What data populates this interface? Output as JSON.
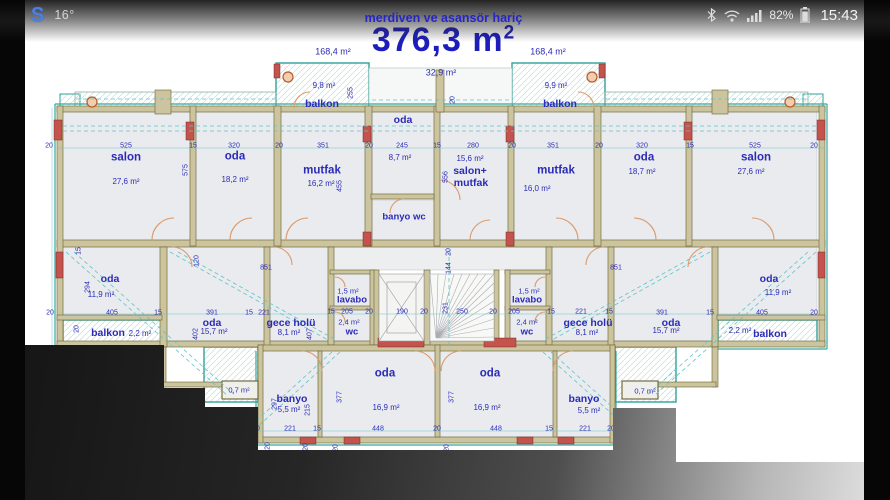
{
  "status_bar": {
    "app_letter": "S",
    "temperature": "16°",
    "battery_pct": "82%",
    "time": "15:43",
    "accent_blue": "#4d7fe3"
  },
  "header": {
    "note": "merdiven ve asansör hariç",
    "total_area": "376,3 m",
    "total_area_sup": "2",
    "text_color": "#1d1dbe"
  },
  "plan": {
    "colors": {
      "wall": "#cbc49e",
      "teal": "#2fa39a",
      "red": "#c4534e",
      "dim_cyan": "#5fc4c9",
      "text_navy": "#2b2bb8"
    },
    "labels": [
      {
        "t": "168,4 m²",
        "x": 333,
        "y": 52,
        "k": "a9"
      },
      {
        "t": "168,4 m²",
        "x": 548,
        "y": 52,
        "k": "a9"
      },
      {
        "t": "32,9 m²",
        "x": 441,
        "y": 73,
        "k": "a9"
      },
      {
        "t": "9,8 m²",
        "x": 324,
        "y": 86,
        "k": "a"
      },
      {
        "t": "balkon",
        "x": 322,
        "y": 104,
        "k": "n11"
      },
      {
        "t": "255",
        "x": 351,
        "y": 93,
        "k": "d",
        "r": 1
      },
      {
        "t": "9,9 m²",
        "x": 556,
        "y": 86,
        "k": "a"
      },
      {
        "t": "balkon",
        "x": 560,
        "y": 104,
        "k": "n11"
      },
      {
        "t": "oda",
        "x": 403,
        "y": 120,
        "k": "n11"
      },
      {
        "t": "20",
        "x": 453,
        "y": 100,
        "k": "d",
        "r": 1
      },
      {
        "t": "20",
        "x": 49,
        "y": 146,
        "k": "d"
      },
      {
        "t": "525",
        "x": 126,
        "y": 146,
        "k": "d"
      },
      {
        "t": "15",
        "x": 193,
        "y": 146,
        "k": "d"
      },
      {
        "t": "320",
        "x": 234,
        "y": 146,
        "k": "d"
      },
      {
        "t": "20",
        "x": 279,
        "y": 146,
        "k": "d"
      },
      {
        "t": "351",
        "x": 323,
        "y": 146,
        "k": "d"
      },
      {
        "t": "20",
        "x": 369,
        "y": 146,
        "k": "d"
      },
      {
        "t": "245",
        "x": 402,
        "y": 146,
        "k": "d"
      },
      {
        "t": "15",
        "x": 437,
        "y": 146,
        "k": "d"
      },
      {
        "t": "280",
        "x": 473,
        "y": 146,
        "k": "d"
      },
      {
        "t": "20",
        "x": 512,
        "y": 146,
        "k": "d"
      },
      {
        "t": "351",
        "x": 553,
        "y": 146,
        "k": "d"
      },
      {
        "t": "20",
        "x": 599,
        "y": 146,
        "k": "d"
      },
      {
        "t": "320",
        "x": 642,
        "y": 146,
        "k": "d"
      },
      {
        "t": "15",
        "x": 690,
        "y": 146,
        "k": "d"
      },
      {
        "t": "525",
        "x": 755,
        "y": 146,
        "k": "d"
      },
      {
        "t": "20",
        "x": 814,
        "y": 146,
        "k": "d"
      },
      {
        "t": "salon",
        "x": 126,
        "y": 158,
        "k": "n12"
      },
      {
        "t": "27,6 m²",
        "x": 126,
        "y": 182,
        "k": "a"
      },
      {
        "t": "oda",
        "x": 235,
        "y": 157,
        "k": "n12"
      },
      {
        "t": "18,2 m²",
        "x": 235,
        "y": 180,
        "k": "a"
      },
      {
        "t": "mutfak",
        "x": 322,
        "y": 171,
        "k": "n12"
      },
      {
        "t": "16,2 m²",
        "x": 321,
        "y": 184,
        "k": "a"
      },
      {
        "t": "8,7 m²",
        "x": 400,
        "y": 158,
        "k": "a"
      },
      {
        "t": "banyo wc",
        "x": 404,
        "y": 217,
        "k": "n10"
      },
      {
        "t": "15,6 m²",
        "x": 470,
        "y": 159,
        "k": "a"
      },
      {
        "t": "salon+",
        "x": 470,
        "y": 171,
        "k": "n11"
      },
      {
        "t": "mutfak",
        "x": 471,
        "y": 183,
        "k": "n11"
      },
      {
        "t": "mutfak",
        "x": 556,
        "y": 171,
        "k": "n12"
      },
      {
        "t": "16,0 m²",
        "x": 537,
        "y": 189,
        "k": "a"
      },
      {
        "t": "oda",
        "x": 644,
        "y": 158,
        "k": "n12"
      },
      {
        "t": "18,7 m²",
        "x": 642,
        "y": 172,
        "k": "a"
      },
      {
        "t": "salon",
        "x": 756,
        "y": 158,
        "k": "n12"
      },
      {
        "t": "27,6 m²",
        "x": 751,
        "y": 172,
        "k": "a"
      },
      {
        "t": "575",
        "x": 186,
        "y": 170,
        "k": "d",
        "r": 1
      },
      {
        "t": "455",
        "x": 340,
        "y": 186,
        "k": "d",
        "r": 1
      },
      {
        "t": "556",
        "x": 446,
        "y": 177,
        "k": "d",
        "r": 1
      },
      {
        "t": "oda",
        "x": 110,
        "y": 279,
        "k": "n11"
      },
      {
        "t": "11,9 m²",
        "x": 101,
        "y": 295,
        "k": "a"
      },
      {
        "t": "294",
        "x": 88,
        "y": 287,
        "k": "d",
        "r": 1
      },
      {
        "t": "15",
        "x": 79,
        "y": 251,
        "k": "d",
        "r": 1
      },
      {
        "t": "20",
        "x": 50,
        "y": 313,
        "k": "d"
      },
      {
        "t": "405",
        "x": 112,
        "y": 313,
        "k": "d"
      },
      {
        "t": "15",
        "x": 158,
        "y": 313,
        "k": "d"
      },
      {
        "t": "balkon",
        "x": 108,
        "y": 333,
        "k": "n11"
      },
      {
        "t": "2,2 m²",
        "x": 140,
        "y": 334,
        "k": "a"
      },
      {
        "t": "20",
        "x": 77,
        "y": 329,
        "k": "d",
        "r": 1
      },
      {
        "t": "851",
        "x": 266,
        "y": 268,
        "k": "d"
      },
      {
        "t": "851",
        "x": 616,
        "y": 268,
        "k": "d"
      },
      {
        "t": "120",
        "x": 197,
        "y": 261,
        "k": "d",
        "r": 1
      },
      {
        "t": "oda",
        "x": 212,
        "y": 323,
        "k": "n11"
      },
      {
        "t": "15,7 m²",
        "x": 214,
        "y": 332,
        "k": "a"
      },
      {
        "t": "391",
        "x": 212,
        "y": 313,
        "k": "d"
      },
      {
        "t": "402",
        "x": 196,
        "y": 334,
        "k": "d",
        "r": 1
      },
      {
        "t": "15",
        "x": 249,
        "y": 313,
        "k": "d"
      },
      {
        "t": "221",
        "x": 264,
        "y": 313,
        "k": "d"
      },
      {
        "t": "gece holü",
        "x": 291,
        "y": 323,
        "k": "n11"
      },
      {
        "t": "8,1 m²",
        "x": 289,
        "y": 333,
        "k": "a"
      },
      {
        "t": "407",
        "x": 310,
        "y": 334,
        "k": "d",
        "r": 1
      },
      {
        "t": "15",
        "x": 331,
        "y": 312,
        "k": "d"
      },
      {
        "t": "205",
        "x": 347,
        "y": 312,
        "k": "d"
      },
      {
        "t": "20",
        "x": 369,
        "y": 312,
        "k": "d"
      },
      {
        "t": "190",
        "x": 402,
        "y": 312,
        "k": "d"
      },
      {
        "t": "20",
        "x": 424,
        "y": 312,
        "k": "d"
      },
      {
        "t": "250",
        "x": 462,
        "y": 312,
        "k": "d"
      },
      {
        "t": "20",
        "x": 493,
        "y": 312,
        "k": "d"
      },
      {
        "t": "205",
        "x": 514,
        "y": 312,
        "k": "d"
      },
      {
        "t": "15",
        "x": 551,
        "y": 312,
        "k": "d"
      },
      {
        "t": "1,5 m²",
        "x": 348,
        "y": 291,
        "k": "a7"
      },
      {
        "t": "lavabo",
        "x": 352,
        "y": 300,
        "k": "n10"
      },
      {
        "t": "2,4 m²",
        "x": 349,
        "y": 322,
        "k": "a7"
      },
      {
        "t": "wc",
        "x": 352,
        "y": 332,
        "k": "n10"
      },
      {
        "t": "1,5 m²",
        "x": 529,
        "y": 291,
        "k": "a7"
      },
      {
        "t": "lavabo",
        "x": 527,
        "y": 300,
        "k": "n10"
      },
      {
        "t": "2,4 m²",
        "x": 527,
        "y": 322,
        "k": "a7"
      },
      {
        "t": "wc",
        "x": 527,
        "y": 332,
        "k": "n10"
      },
      {
        "t": "20",
        "x": 449,
        "y": 252,
        "k": "d",
        "r": 1
      },
      {
        "t": "144",
        "x": 449,
        "y": 268,
        "k": "d",
        "r": 1
      },
      {
        "t": "231",
        "x": 446,
        "y": 308,
        "k": "d",
        "r": 1
      },
      {
        "t": "gece holü",
        "x": 588,
        "y": 323,
        "k": "n11"
      },
      {
        "t": "8,1 m²",
        "x": 587,
        "y": 333,
        "k": "a"
      },
      {
        "t": "221",
        "x": 581,
        "y": 312,
        "k": "d"
      },
      {
        "t": "15",
        "x": 609,
        "y": 312,
        "k": "d"
      },
      {
        "t": "oda",
        "x": 671,
        "y": 323,
        "k": "n11"
      },
      {
        "t": "15,7 m²",
        "x": 666,
        "y": 331,
        "k": "a"
      },
      {
        "t": "391",
        "x": 662,
        "y": 313,
        "k": "d"
      },
      {
        "t": "15",
        "x": 710,
        "y": 313,
        "k": "d"
      },
      {
        "t": "oda",
        "x": 769,
        "y": 279,
        "k": "n11"
      },
      {
        "t": "11,9 m²",
        "x": 778,
        "y": 293,
        "k": "a"
      },
      {
        "t": "405",
        "x": 762,
        "y": 313,
        "k": "d"
      },
      {
        "t": "20",
        "x": 814,
        "y": 313,
        "k": "d"
      },
      {
        "t": "2,2 m²",
        "x": 740,
        "y": 331,
        "k": "a"
      },
      {
        "t": "balkon",
        "x": 770,
        "y": 334,
        "k": "n11"
      },
      {
        "t": "0,7 m²",
        "x": 239,
        "y": 390,
        "k": "a7"
      },
      {
        "t": "0,7 m²",
        "x": 645,
        "y": 391,
        "k": "a7"
      },
      {
        "t": "banyo",
        "x": 292,
        "y": 399,
        "k": "n11"
      },
      {
        "t": "5,5 m²",
        "x": 289,
        "y": 410,
        "k": "a"
      },
      {
        "t": "297",
        "x": 275,
        "y": 404,
        "k": "d",
        "r": 1
      },
      {
        "t": "215",
        "x": 308,
        "y": 410,
        "k": "d",
        "r": 1
      },
      {
        "t": "oda",
        "x": 385,
        "y": 374,
        "k": "n12"
      },
      {
        "t": "16,9 m²",
        "x": 386,
        "y": 408,
        "k": "a"
      },
      {
        "t": "377",
        "x": 340,
        "y": 397,
        "k": "d",
        "r": 1
      },
      {
        "t": "oda",
        "x": 490,
        "y": 374,
        "k": "n12"
      },
      {
        "t": "16,9 m²",
        "x": 487,
        "y": 408,
        "k": "a"
      },
      {
        "t": "377",
        "x": 452,
        "y": 397,
        "k": "d",
        "r": 1
      },
      {
        "t": "banyo",
        "x": 584,
        "y": 399,
        "k": "n11"
      },
      {
        "t": "5,5 m²",
        "x": 589,
        "y": 411,
        "k": "a"
      },
      {
        "t": "20",
        "x": 256,
        "y": 429,
        "k": "d"
      },
      {
        "t": "221",
        "x": 290,
        "y": 429,
        "k": "d"
      },
      {
        "t": "15",
        "x": 317,
        "y": 429,
        "k": "d"
      },
      {
        "t": "448",
        "x": 378,
        "y": 429,
        "k": "d"
      },
      {
        "t": "20",
        "x": 437,
        "y": 429,
        "k": "d"
      },
      {
        "t": "448",
        "x": 496,
        "y": 429,
        "k": "d"
      },
      {
        "t": "15",
        "x": 549,
        "y": 429,
        "k": "d"
      },
      {
        "t": "221",
        "x": 585,
        "y": 429,
        "k": "d"
      },
      {
        "t": "20",
        "x": 611,
        "y": 429,
        "k": "d"
      },
      {
        "t": "20",
        "x": 268,
        "y": 446,
        "k": "d",
        "r": 1
      },
      {
        "t": "20",
        "x": 306,
        "y": 447,
        "k": "d",
        "r": 1
      },
      {
        "t": "20",
        "x": 336,
        "y": 448,
        "k": "d",
        "r": 1
      },
      {
        "t": "20",
        "x": 447,
        "y": 448,
        "k": "d",
        "r": 1
      }
    ]
  }
}
